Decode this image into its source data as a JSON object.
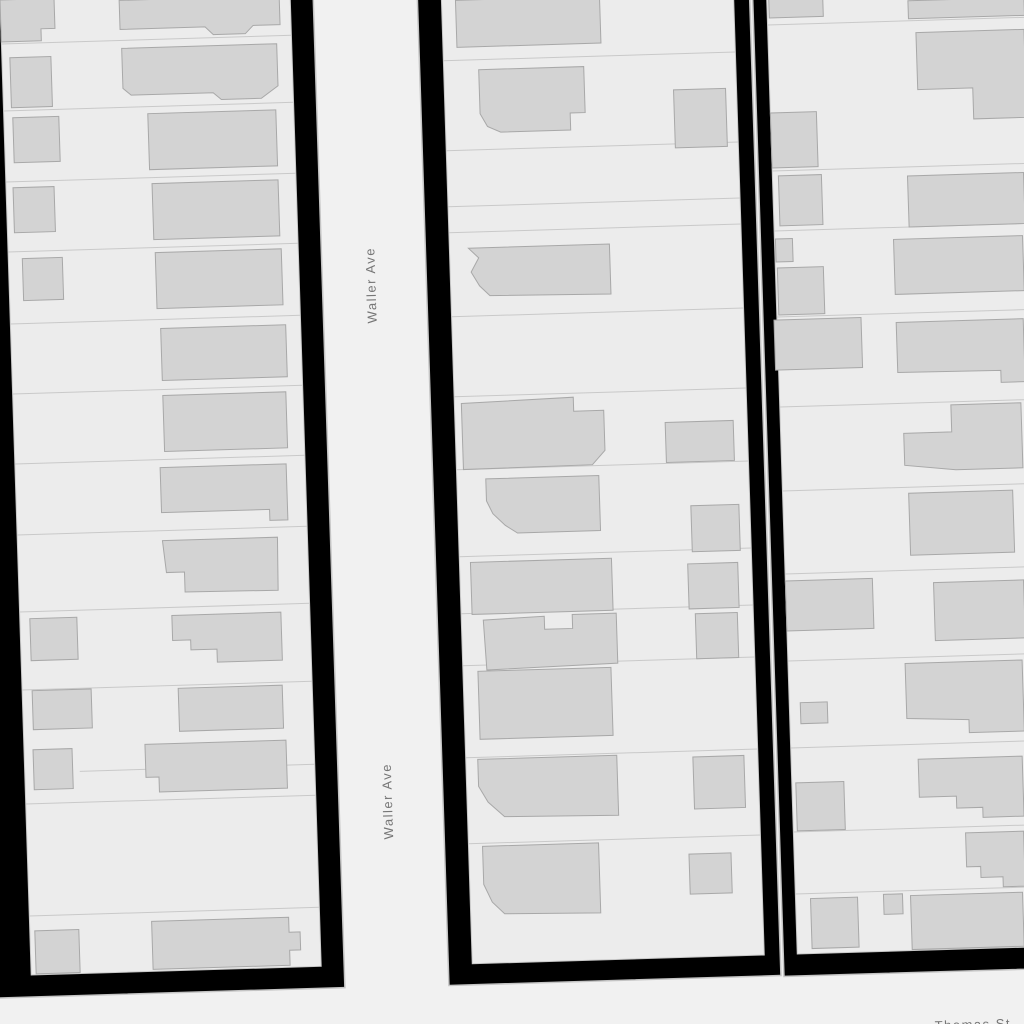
{
  "map": {
    "colors": {
      "street": "#f1f1f1",
      "block_outline": "#000000",
      "street_casing": "#c4c4c4",
      "parcel": "#ececec",
      "parcel_line": "#c9c9c9",
      "building": "#d3d3d3",
      "building_outline": "#a8a8a8",
      "label": "#767676",
      "label_halo": "#f1f1f1"
    },
    "shear": "matrix(1,-0.03,0.032,1,0,0)",
    "street_labels": [
      {
        "text": "Waller Ave",
        "x": 366,
        "y": 296,
        "rotate": -90,
        "space": "local"
      },
      {
        "text": "Waller Ave",
        "x": 366,
        "y": 812,
        "rotate": -90,
        "space": "local"
      },
      {
        "text": "Thomas St",
        "x": 973,
        "y": 1029,
        "rotate": -1.8,
        "space": "screen"
      }
    ],
    "blocks": [
      {
        "name": "west-block",
        "outer": [
          -60,
          -40,
          373,
          1037
        ],
        "parcel_area": [
          0,
          -40,
          290,
          1015
        ],
        "lot_lines": [
          [
            0,
            44,
            290,
            44
          ],
          [
            0,
            111,
            290,
            111
          ],
          [
            0,
            182,
            290,
            182
          ],
          [
            0,
            252,
            290,
            252
          ],
          [
            0,
            324,
            290,
            324
          ],
          [
            0,
            394,
            290,
            394
          ],
          [
            0,
            464,
            290,
            464
          ],
          [
            0,
            535,
            290,
            535
          ],
          [
            0,
            612,
            290,
            612
          ],
          [
            0,
            690,
            290,
            690
          ],
          [
            55,
            773,
            290,
            773
          ],
          [
            0,
            804,
            290,
            804
          ],
          [
            0,
            916,
            290,
            916
          ]
        ],
        "buildings": [
          {
            "p": "0,0 54,0 54,30 40,30 40,42 0,42"
          },
          {
            "p": "119,4 279,4 279,33 252,33 244,41 212,41 204,33 119,33"
          },
          {
            "r": [
              8,
              58,
              41,
              50
            ]
          },
          {
            "p": "120,52 275,52 275,94 258,106 218,106 210,99 128,99 120,92"
          },
          {
            "r": [
              9,
              118,
              46,
              45
            ]
          },
          {
            "r": [
              144,
              118,
              128,
              56
            ]
          },
          {
            "r": [
              7,
              188,
              41,
              45
            ]
          },
          {
            "r": [
              146,
              188,
              126,
              56
            ]
          },
          {
            "r": [
              14,
              259,
              40,
              42
            ]
          },
          {
            "r": [
              147,
              257,
              126,
              56
            ]
          },
          {
            "r": [
              150,
              333,
              125,
              52
            ]
          },
          {
            "r": [
              150,
              400,
              123,
              56
            ]
          },
          {
            "p": "145,472 271,472 271,528 253,528 253,517 145,517"
          },
          {
            "p": "145,545 260,545 259,598 166,597 166,577 148,577"
          },
          {
            "r": [
              10,
              619,
              47,
              42
            ]
          },
          {
            "p": "152,620 261,620 261,668 196,668 196,655 170,655 170,645 152,645"
          },
          {
            "r": [
              10,
              691,
              59,
              39
            ]
          },
          {
            "r": [
              156,
              693,
              104,
              43
            ]
          },
          {
            "r": [
              9,
              750,
              39,
              40
            ]
          },
          {
            "p": "121,748 262,748 262,796 134,796 134,781 121,781"
          },
          {
            "r": [
              5,
              931,
              44,
              43
            ]
          },
          {
            "p": "122,925 259,925 259,940 270,940 270,958 259,958 259,973 122,973"
          }
        ]
      },
      {
        "name": "center-block",
        "outer": [
          417,
          -40,
          332,
          1038
        ],
        "parcel_area": [
          441,
          -40,
          292,
          1017
        ],
        "lot_lines": [
          [
            441,
            74,
            733,
            74
          ],
          [
            441,
            164,
            733,
            164
          ],
          [
            441,
            220,
            733,
            220
          ],
          [
            441,
            246,
            733,
            246
          ],
          [
            441,
            330,
            733,
            330
          ],
          [
            441,
            410,
            733,
            410
          ],
          [
            441,
            483,
            733,
            483
          ],
          [
            441,
            570,
            733,
            570
          ],
          [
            441,
            627,
            733,
            627
          ],
          [
            441,
            679,
            733,
            679
          ],
          [
            441,
            771,
            733,
            771
          ],
          [
            441,
            857,
            733,
            857
          ]
        ],
        "buildings": [
          {
            "r": [
              455,
              14,
              144,
              47
            ]
          },
          {
            "p": "476,84 581,84 581,130 566,130 566,147 496,147 483,141 476,128"
          },
          {
            "r": [
              670,
              110,
              52,
              58
            ]
          },
          {
            "p": "460,262 601,262 601,312 480,310 470,300 462,286 470,272"
          },
          {
            "p": "448,417 560,414 560,428 590,428 590,468 577,482 448,483"
          },
          {
            "r": [
              651,
              442,
              68,
              40
            ]
          },
          {
            "p": "470,493 583,493 583,548 500,548 488,540 476,528 470,515"
          },
          {
            "r": [
              674,
              526,
              48,
              46
            ]
          },
          {
            "r": [
              452,
              576,
              141,
              52
            ]
          },
          {
            "r": [
              669,
              584,
              50,
              45
            ]
          },
          {
            "p": "463,634 524,632 524,645 552,645 552,631 596,631 596,681 465,684"
          },
          {
            "r": [
              675,
              634,
              42,
              45
            ]
          },
          {
            "r": [
              456,
              685,
              133,
              68
            ]
          },
          {
            "p": "453,773 592,773 592,833 478,831 462,816 453,800"
          },
          {
            "r": [
              668,
              777,
              51,
              52
            ]
          },
          {
            "p": "455,860 571,860 571,930 475,928 463,916 455,898"
          },
          {
            "r": [
              661,
              874,
              42,
              40
            ]
          }
        ]
      },
      {
        "name": "east-block",
        "outer": [
          752,
          -40,
          318,
          1039
        ],
        "parcel_area": [
          766,
          -40,
          304,
          1017
        ],
        "lot_lines": [
          [
            766,
            48,
            1070,
            48
          ],
          [
            766,
            194,
            1070,
            194
          ],
          [
            766,
            254,
            1070,
            254
          ],
          [
            766,
            340,
            1070,
            340
          ],
          [
            766,
            430,
            1070,
            430
          ],
          [
            766,
            514,
            1070,
            514
          ],
          [
            766,
            597,
            1070,
            597
          ],
          [
            766,
            684,
            1070,
            684
          ],
          [
            766,
            771,
            1070,
            771
          ],
          [
            766,
            855,
            1070,
            855
          ],
          [
            766,
            917,
            1070,
            917
          ]
        ],
        "buildings": [
          {
            "r": [
              768,
              22,
              54,
              19
            ]
          },
          {
            "r": [
              907,
              28,
              116,
              18
            ]
          },
          {
            "p": "914,60 1022,60 1022,148 969,148 969,117 914,117"
          },
          {
            "r": [
              766,
              136,
              46,
              55
            ]
          },
          {
            "r": [
              772,
              199,
              43,
              50
            ]
          },
          {
            "r": [
              901,
              203,
              116,
              51
            ]
          },
          {
            "r": [
              767,
              262,
              17,
              23
            ]
          },
          {
            "r": [
              768,
              291,
              46,
              47
            ]
          },
          {
            "r": [
              885,
              266,
              129,
              55
            ]
          },
          {
            "r": [
              763,
              343,
              87,
              50
            ]
          },
          {
            "p": "885,349 1012,349 1012,412 988,412 988,400 885,399"
          },
          {
            "p": "889,460 937,460 937,433 1007,433 1007,498 940,498 889,492"
          },
          {
            "r": [
              892,
              520,
              104,
              62
            ]
          },
          {
            "r": [
              766,
              604,
              87,
              50
            ]
          },
          {
            "r": [
              914,
              610,
              90,
              58
            ]
          },
          {
            "r": [
              777,
              726,
              27,
              21
            ]
          },
          {
            "p": "883,690 1000,690 1000,761 945,761 945,748 883,745"
          },
          {
            "r": [
              770,
              806,
              48,
              48
            ]
          },
          {
            "p": "893,786 997,786 997,846 956,846 956,836 930,836 930,824 893,824"
          },
          {
            "p": "938,861 996,861 996,916 974,916 974,906 952,906 952,895 938,895"
          },
          {
            "r": [
              781,
              922,
              47,
              50
            ]
          },
          {
            "r": [
              854,
              920,
              19,
              20
            ]
          },
          {
            "r": [
              881,
              922,
              112,
              54
            ]
          }
        ]
      }
    ]
  }
}
